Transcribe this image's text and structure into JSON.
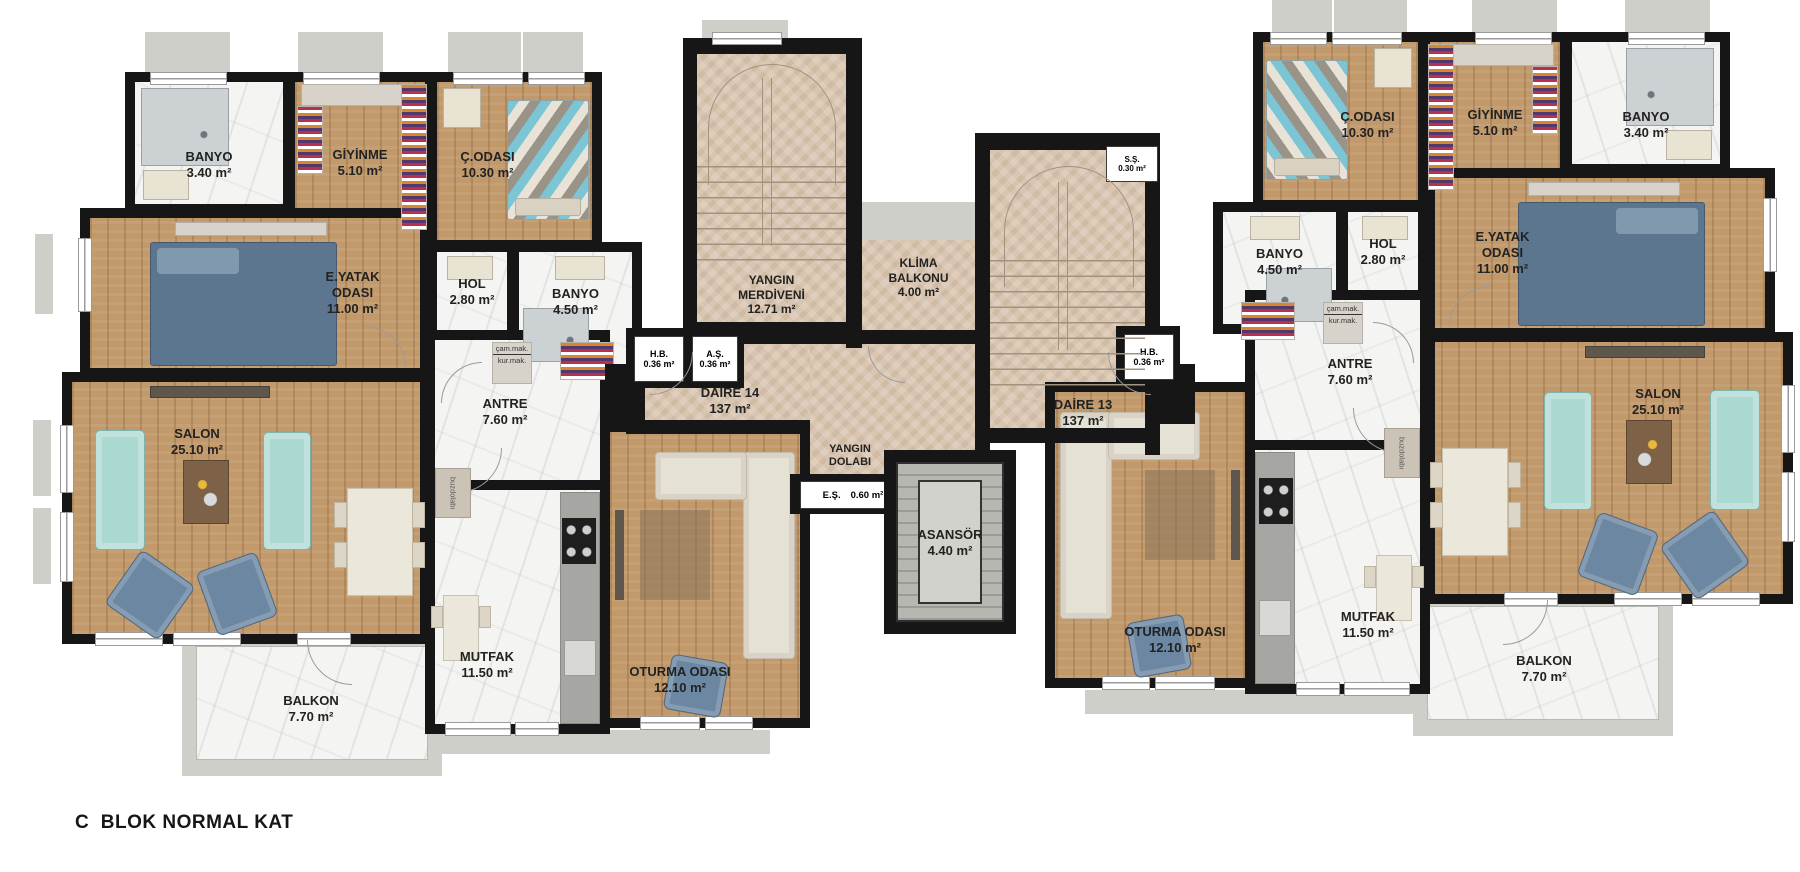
{
  "title": "C  BLOK NORMAL KAT",
  "apartments": {
    "left": {
      "name": "DAİRE 14",
      "area": "137 m²"
    },
    "right": {
      "name": "DAİRE 13",
      "area": "137 m²"
    }
  },
  "rooms": {
    "banyo_small": {
      "name": "BANYO",
      "area": "3.40 m²"
    },
    "giyinme": {
      "name": "GİYİNME",
      "area": "5.10 m²"
    },
    "cocuk_odasi": {
      "name": "Ç.ODASI",
      "area": "10.30 m²"
    },
    "ebeveyn_yatak": {
      "name": "E.YATAK\nODASI",
      "area": "11.00 m²"
    },
    "hol": {
      "name": "HOL",
      "area": "2.80 m²"
    },
    "banyo_buyuk": {
      "name": "BANYO",
      "area": "4.50 m²"
    },
    "antre": {
      "name": "ANTRE",
      "area": "7.60 m²"
    },
    "salon": {
      "name": "SALON",
      "area": "25.10 m²"
    },
    "mutfak": {
      "name": "MUTFAK",
      "area": "11.50 m²"
    },
    "oturma_odasi": {
      "name": "OTURMA ODASI",
      "area": "12.10 m²"
    },
    "balkon": {
      "name": "BALKON",
      "area": "7.70 m²"
    }
  },
  "core": {
    "yangin_merdiveni": {
      "name": "YANGIN\nMERDİVENİ",
      "area": "12.71 m²"
    },
    "klima_balkonu": {
      "name": "KLİMA\nBALKONU",
      "area": "4.00 m²"
    },
    "yangin_dolabi": {
      "name": "YANGIN\nDOLABI",
      "area": ""
    },
    "asansor": {
      "name": "ASANSÖR",
      "area": "4.40 m²"
    },
    "es": {
      "name": "E.Ş.",
      "area": "0.60 m²"
    },
    "ss": {
      "name": "S.Ş.",
      "area": "0.30 m²"
    },
    "hb": {
      "name": "H.B.",
      "area": "0.36 m²"
    },
    "as": {
      "name": "A.Ş.",
      "area": "0.36 m²"
    }
  },
  "appliances": {
    "cam_mak": "çam.mak.",
    "kur_mak": "kur.mak.",
    "buzdolabi": "buzdolabı"
  },
  "colors": {
    "wall": "#161616",
    "wood_floor": "#c2996b",
    "marble_floor": "#f4f4f2",
    "tile_floor": "#d9c5b0",
    "slab_gray": "#cfcfca",
    "sofa_teal": "#abd8d0",
    "sofa_blue": "#6b87a1",
    "sofa_cream": "#e6e1d5",
    "bed_blue": "#5c7690",
    "bed_chevron_teal": "#7cc5d4"
  }
}
